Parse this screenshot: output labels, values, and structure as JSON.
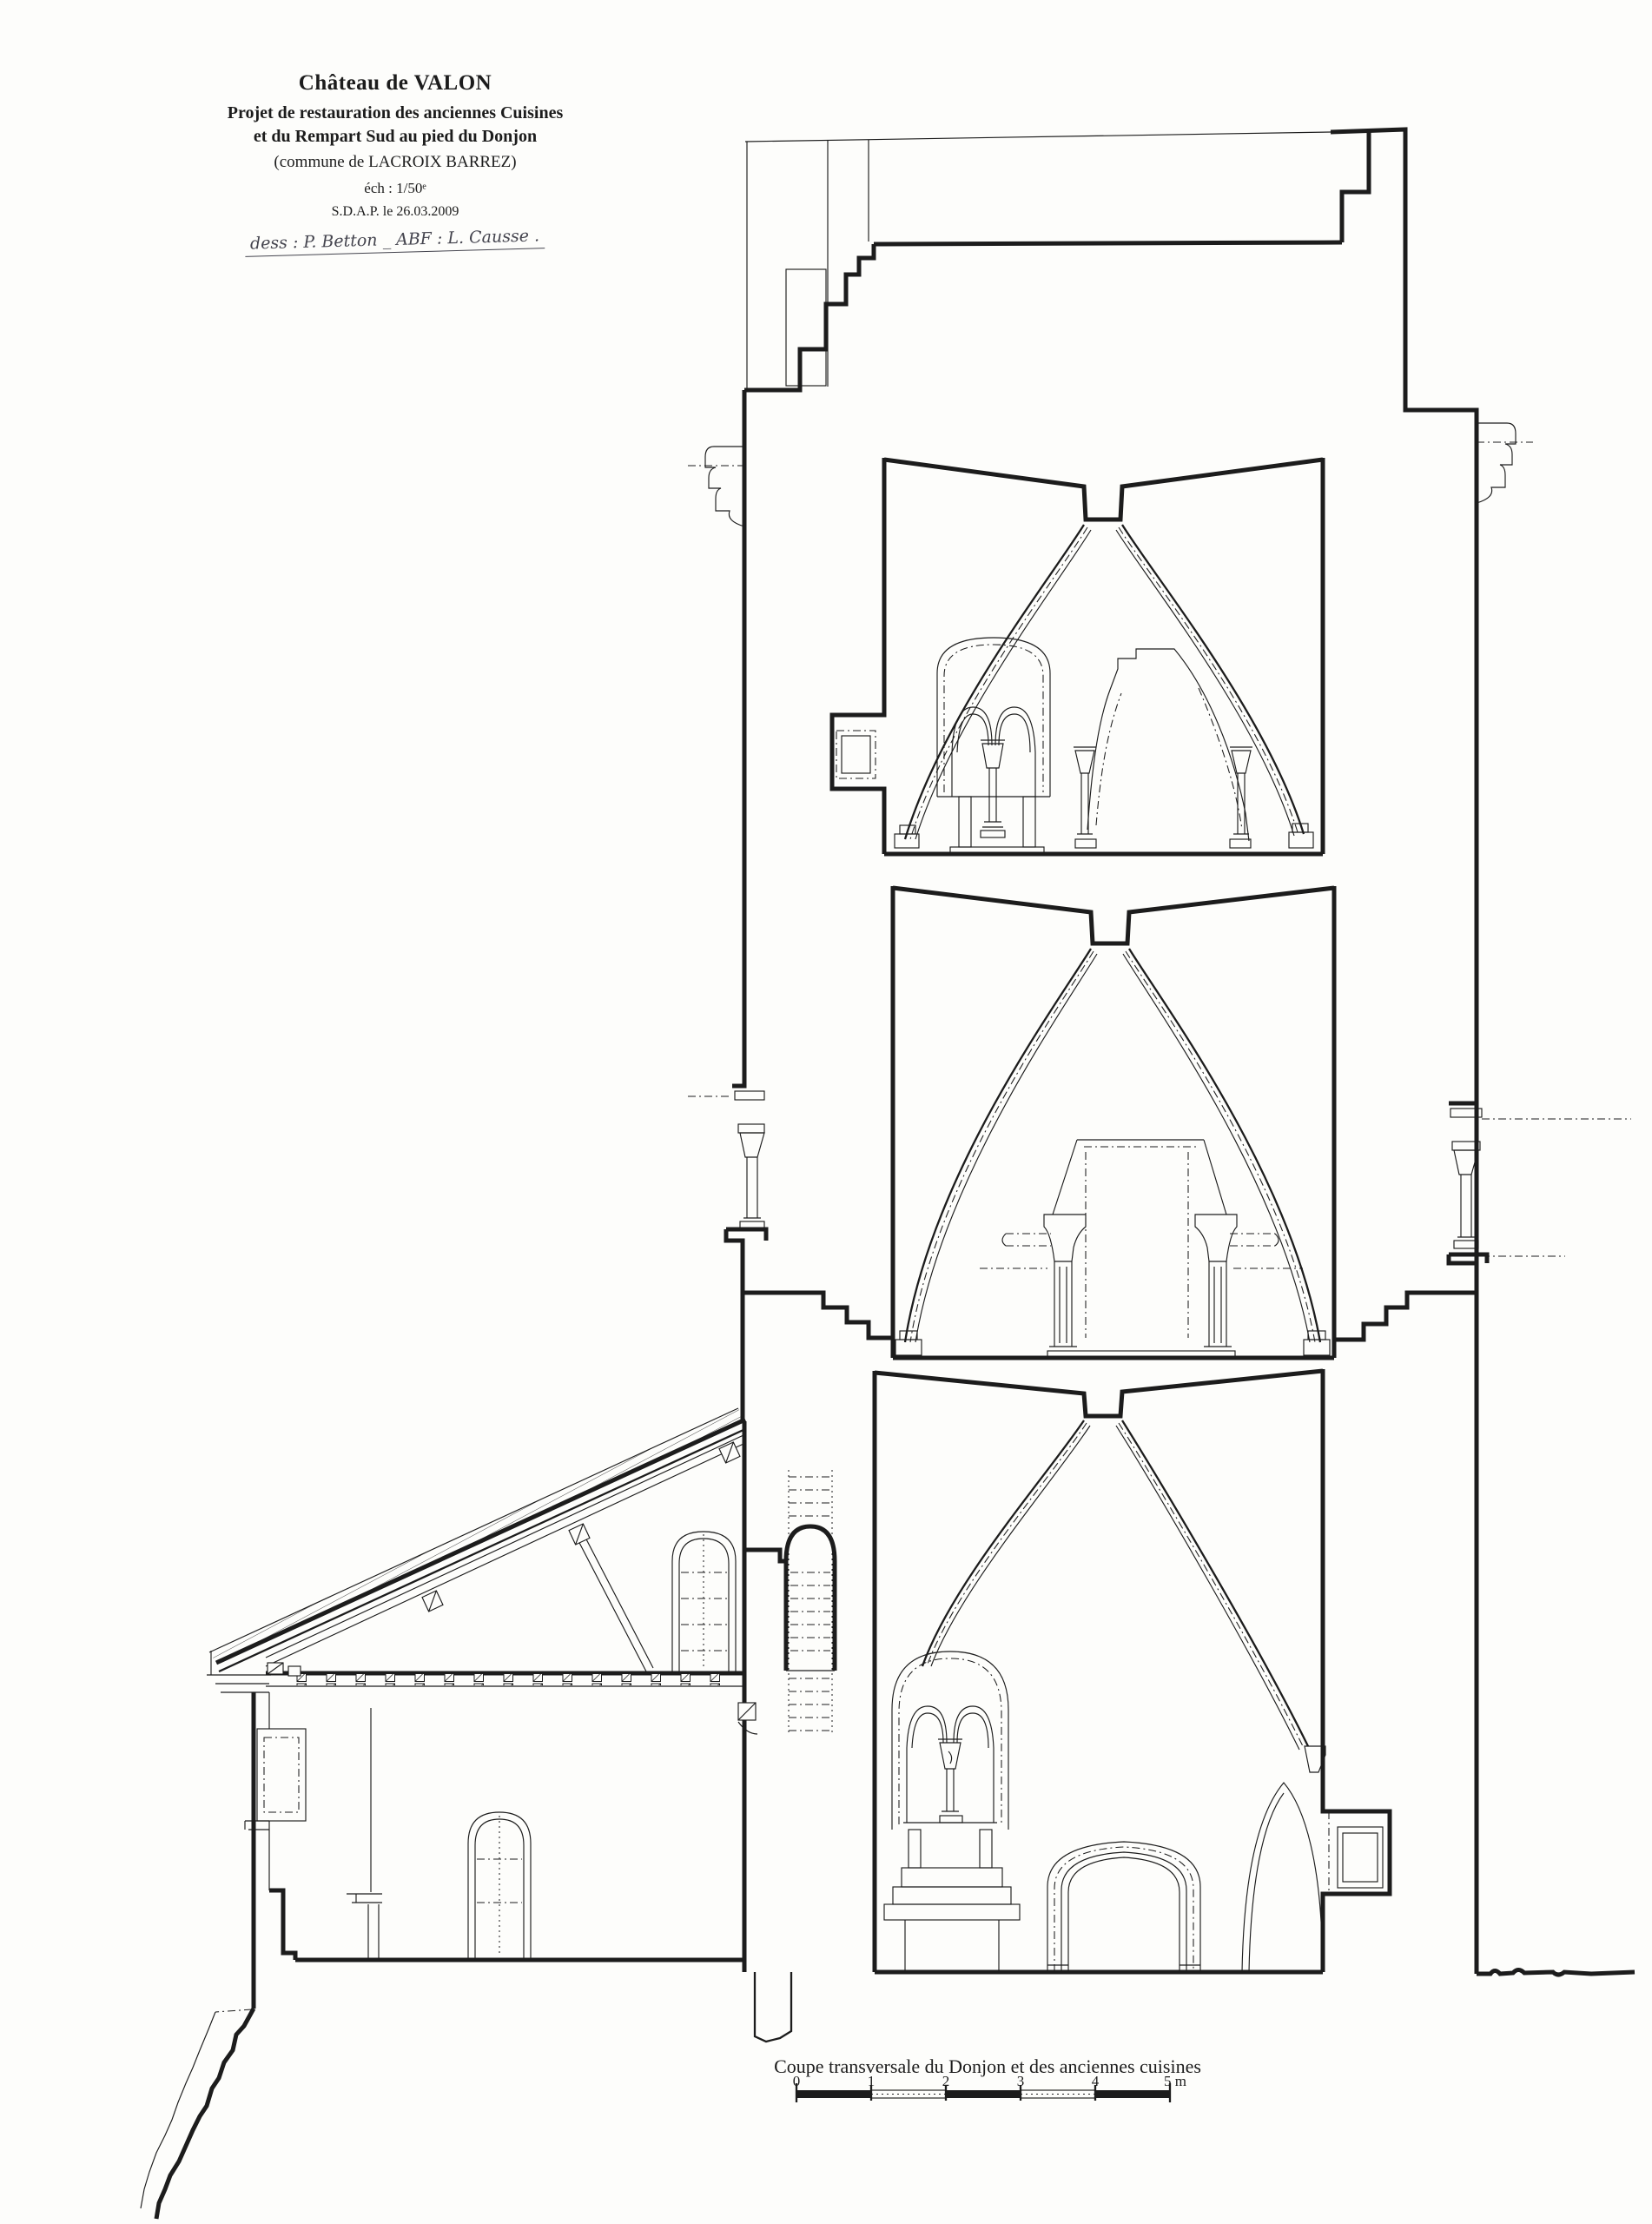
{
  "page": {
    "background": "#fdfdfb"
  },
  "drawing": {
    "type": "architectural-cross-section",
    "ink_color": "#1c1c1c",
    "paper_color": "#fdfdfb",
    "handwriting_color": "#44444e"
  },
  "title_block": {
    "title": "Château de VALON",
    "subtitle_1": "Projet de restauration des anciennes Cuisines",
    "subtitle_2": "et du Rempart Sud au pied du Donjon",
    "commune": "(commune de LACROIX BARREZ)",
    "scale_note": "éch : 1/50ᵉ",
    "date_note": "S.D.A.P. le 26.03.2009",
    "handwritten_note": "dess : P. Betton _   ABF : L. Causse ."
  },
  "caption": {
    "text": "Coupe transversale du Donjon et des anciennes cuisines"
  },
  "scale_bar": {
    "tick_labels": [
      "0",
      "1",
      "2",
      "3",
      "4"
    ],
    "end_label": "5 m"
  }
}
